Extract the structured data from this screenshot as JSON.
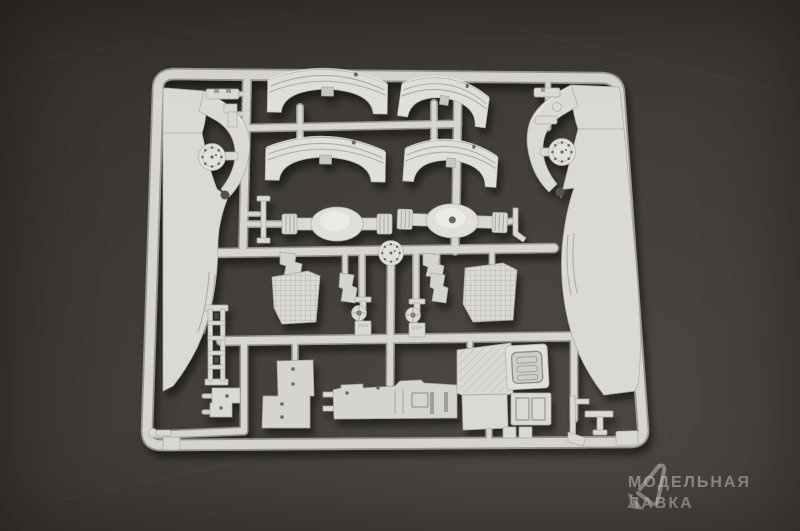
{
  "photo": {
    "subject": "plastic-model-kit-sprue-with-truck-chassis-parts",
    "background_color_center": "#4d4843",
    "background_color_edge": "#2d2a27",
    "plastic_color": "#dbd9d4",
    "plastic_shadow_color": "#98948f",
    "parts": [
      "sprue-frame",
      "left-chassis-rail",
      "right-chassis-rail",
      "fender-upper-left",
      "fender-lower-left",
      "fender-upper-right",
      "fender-lower-right",
      "axle-left",
      "axle-right",
      "hub-disc-left",
      "hub-disc-right",
      "hub-disc-center",
      "steering-knuckle-left",
      "steering-knuckle-right",
      "corner-bracket-left",
      "corner-bracket-right",
      "angle-bracket-left",
      "angle-bracket-right",
      "textured-panel-left",
      "textured-panel-right",
      "ladder-frame-piece",
      "stepped-panel",
      "hood-panel",
      "cab-floor-slab",
      "window-frame-upper",
      "window-frame-lower",
      "small-clip-top-left",
      "small-clips-top-right",
      "small-bracket-bottom-left",
      "knob-part-bottom-left",
      "flag-part-bottom-right",
      "t-part-bottom-right",
      "corner-panel-bottom-right"
    ]
  },
  "watermark": {
    "line1": "МОДЕЛЬНАЯ",
    "line2": "ЛАВКА",
    "logo_icon": "model-lavka-logo",
    "text_color": "rgba(213,207,200,0.52)"
  }
}
